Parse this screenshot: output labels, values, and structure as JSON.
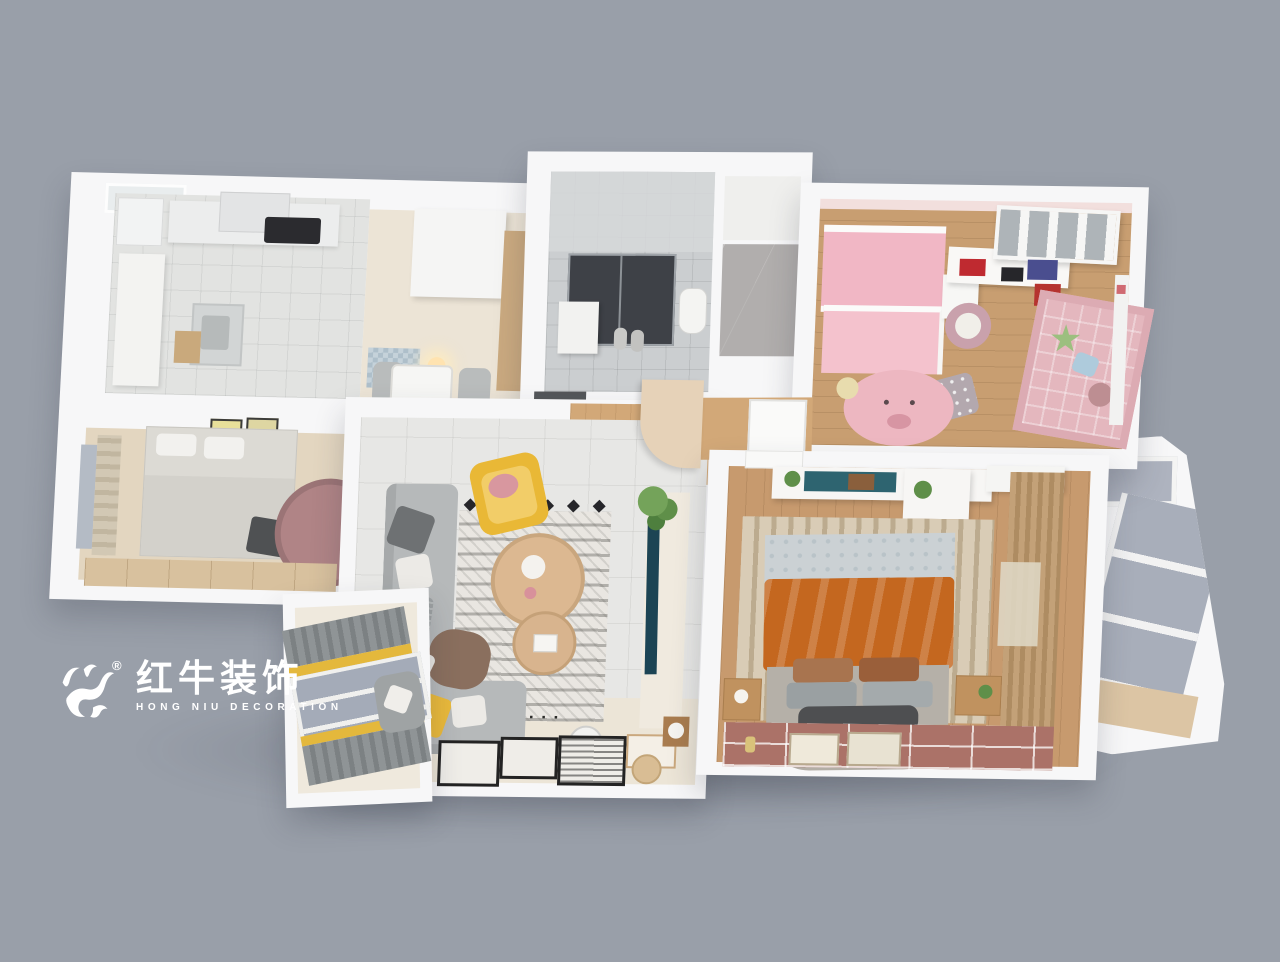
{
  "scene": {
    "type": "3d-apartment-floorplan-render",
    "background": "#999fa9",
    "rooms_visible": [
      "kitchen",
      "dining-area",
      "bathroom",
      "utility-room",
      "kids-bedroom",
      "bedroom",
      "living-room",
      "master-bedroom",
      "right-balcony",
      "bay-window-balcony",
      "hallway"
    ]
  },
  "logo": {
    "icon": "bull-logo-icon",
    "registered_mark": "®",
    "brand_cn": "红牛装饰",
    "brand_en": "HONG NIU DECORATION",
    "color": "#ffffff"
  },
  "colors": {
    "bg": "#999fa9",
    "wall": "#f7f7f8",
    "kitchen-tile": "#e2e3e1",
    "bath-tile": "#cbced0",
    "shower-dark": "#3e4147",
    "marble": "#b1aead",
    "kids-wood": "#c89e71",
    "master-wood": "#c79a6e",
    "hall-wood": "#d2a878",
    "living-tile": "#e7e7e5",
    "living-beige": "#ece5d7",
    "sofa-gray": "#b6b9ba",
    "accent-yellow": "#e9b93b",
    "rug-base": "#e9e6e1",
    "pink-bed": "#f1b7c5",
    "pink-mat": "#e4b7be",
    "pig-rug": "#edb7c1",
    "orange-blanket": "#c4671f",
    "rose-rug": "#ab7268",
    "curtain-tan": "#c3a178",
    "curtain-gray": "#8f9496",
    "glass-blue": "#a8aeba",
    "tv-teal": "#1c4454",
    "desk-teal": "#2e6470",
    "plant-green": "#5f8f49",
    "mauve-rug": "#b08486",
    "dark-wall": "#6b6b67",
    "logo-white": "#ffffff"
  }
}
